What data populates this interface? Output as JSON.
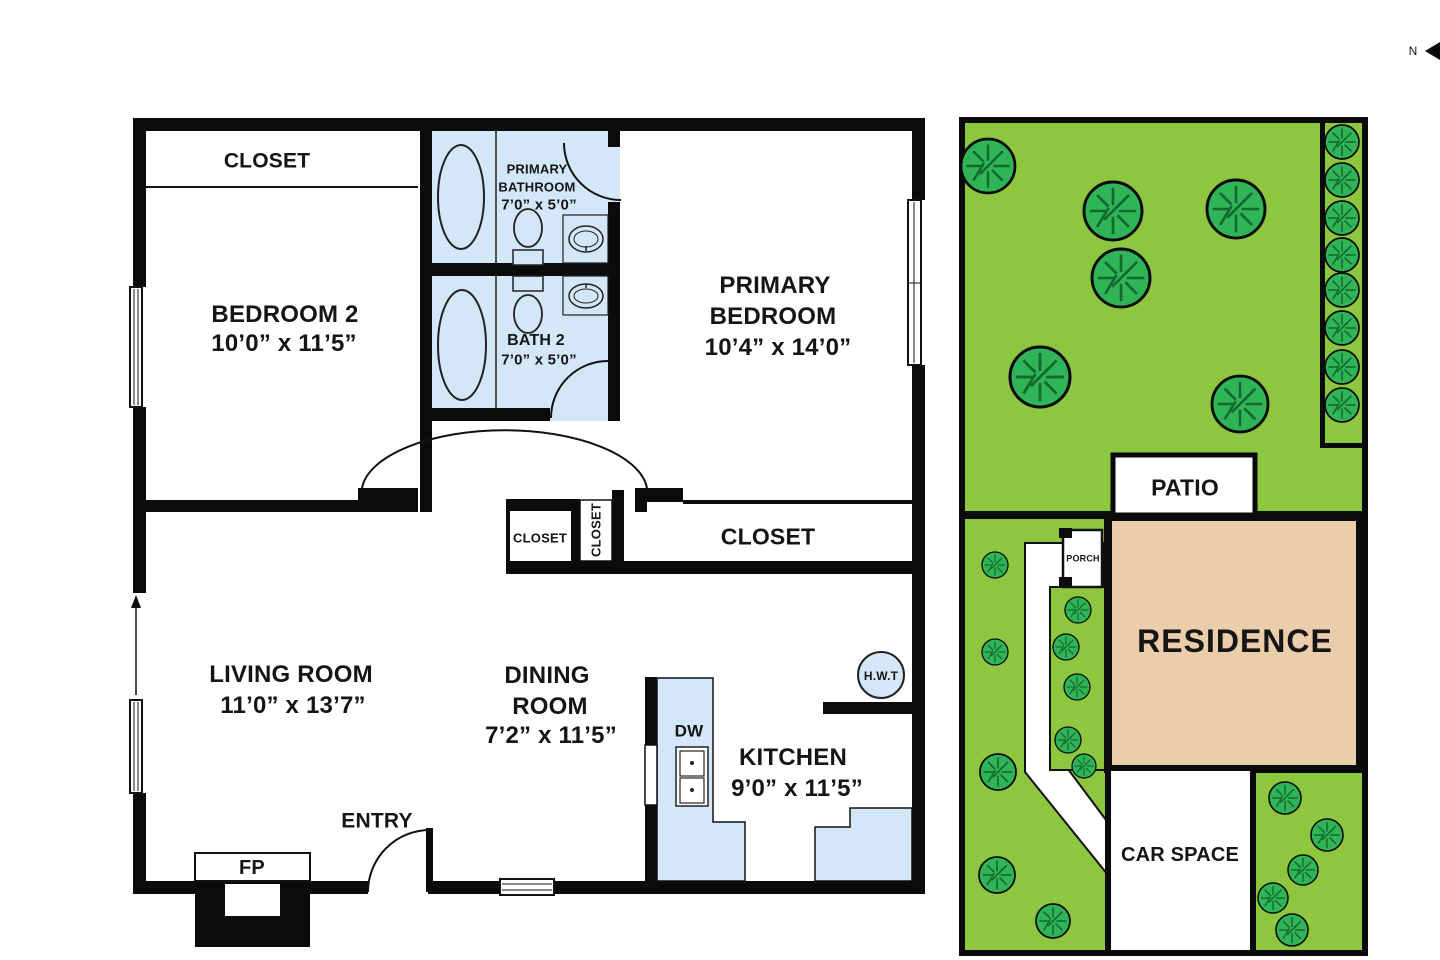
{
  "title": "Floor plan with site plan",
  "compass": {
    "north_label": "N"
  },
  "floor_plan": {
    "closet_top_label": "CLOSET",
    "bedroom2": {
      "name": "BEDROOM 2",
      "dims": "10’0” x 11’5”"
    },
    "primary_bathroom": {
      "name_line1": "PRIMARY",
      "name_line2": "BATHROOM",
      "dims": "7’0” x 5’0”"
    },
    "bath2": {
      "name": "BATH 2",
      "dims": "7’0” x 5’0”"
    },
    "primary_bedroom": {
      "name_line1": "PRIMARY",
      "name_line2": "BEDROOM",
      "dims": "10’4” x 14’0”"
    },
    "closet_small_label": "CLOSET",
    "closet_vertical_label": "CLOSET",
    "closet_primary_label": "CLOSET",
    "living_room": {
      "name": "LIVING ROOM",
      "dims": "11’0” x 13’7”"
    },
    "dining_room": {
      "name_line1": "DINING",
      "name_line2": "ROOM",
      "dims": "7’2” x 11’5”"
    },
    "kitchen": {
      "name": "KITCHEN",
      "dims": "9’0” x 11’5”"
    },
    "entry_label": "ENTRY",
    "fireplace_label": "FP",
    "dishwasher_label": "DW",
    "water_heater_label": "H.W.T"
  },
  "site_plan": {
    "patio_label": "PATIO",
    "porch_label": "PORCH",
    "residence_label": "RESIDENCE",
    "car_space_label": "CAR SPACE"
  },
  "colors": {
    "wall": "#0b0b0b",
    "fixture_blue": "#d3e7f8",
    "lawn_green": "#8dc63f",
    "tree_green": "#2fb457",
    "tree_line": "#14682e",
    "residence_tan": "#eacdab"
  }
}
